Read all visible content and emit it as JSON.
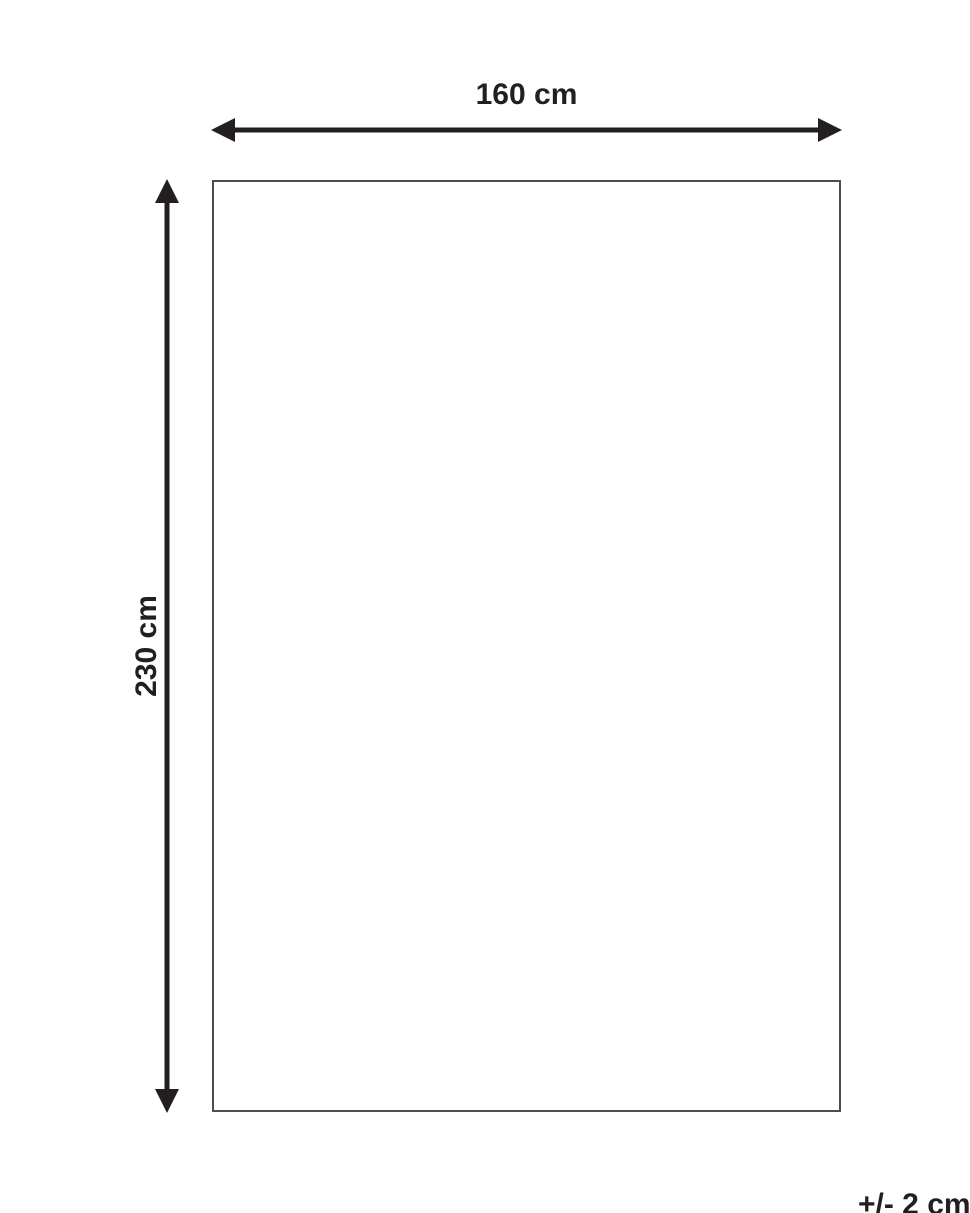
{
  "diagram": {
    "width_label": "160 cm",
    "height_label": "230 cm",
    "tolerance_label": "+/- 2 cm",
    "colors": {
      "arrow_and_text": "#231f20",
      "rectangle_border": "#4d4d4f",
      "background": "#ffffff"
    }
  }
}
